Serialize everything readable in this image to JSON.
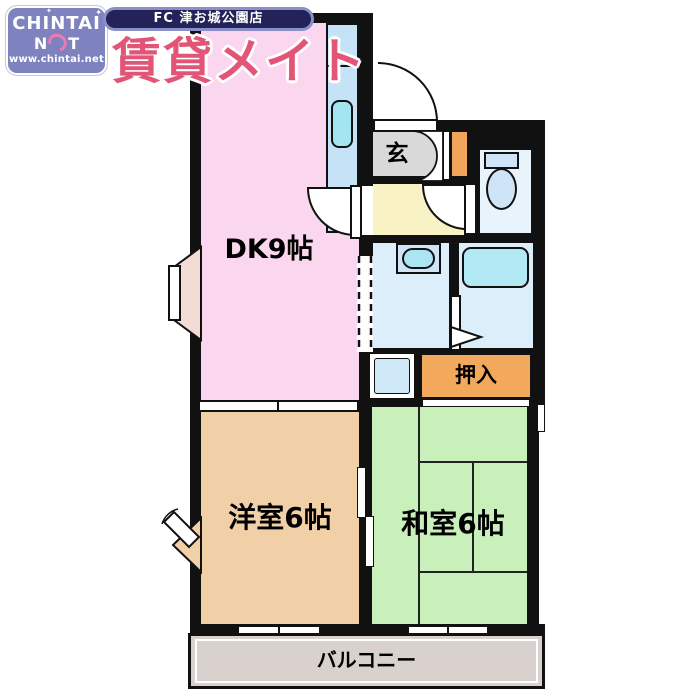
{
  "header": {
    "logo_line1": "CHINTAI",
    "logo_n": "N",
    "logo_t": "T",
    "logo_url": "www.chintai.net",
    "branch": "FC 津お城公園店",
    "brand": "賃貸メイト"
  },
  "floorplan": {
    "dk_label": "DK9帖",
    "genkan_label": "玄",
    "closet_label": "押入",
    "western_room_label": "洋室6帖",
    "japanese_room_label": "和室6帖",
    "balcony_label": "バルコニー"
  },
  "colors": {
    "wall": "#111111",
    "dk_room": "#fbd7ef",
    "western_room": "#f2d0a7",
    "japanese_room": "#c9efba",
    "genkan": "#d9d9d9",
    "hallway": "#f8f2c4",
    "wet_area_floor": "#dceef9",
    "toilet_room": "#e9f3fc",
    "bathtub": "#b2e9f4",
    "kitchen_counter": "#c6e2f6",
    "closet_orange": "#f2a95c",
    "balcony": "#d8d1cd",
    "logo_purple": "#7e83bf",
    "banner_navy": "#23235a",
    "brand_pink": "#e25577"
  }
}
